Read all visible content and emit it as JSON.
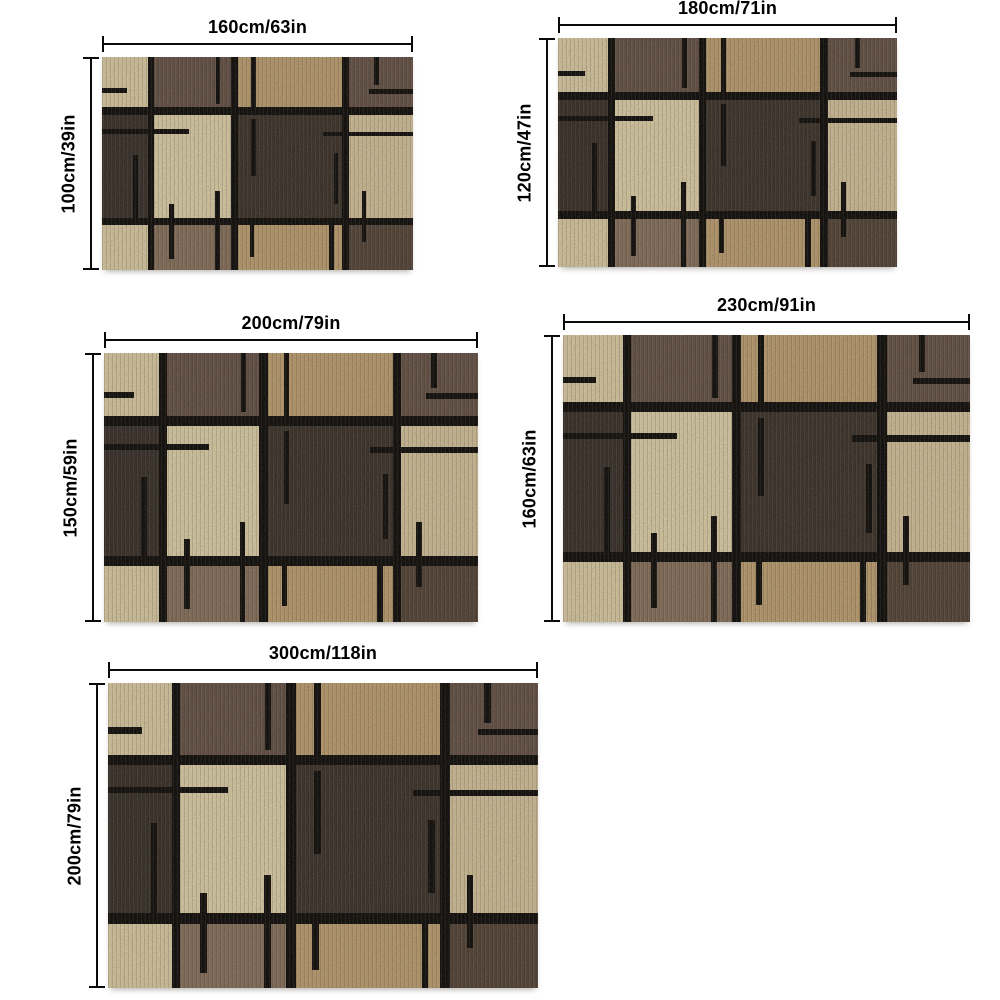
{
  "product": {
    "description": "Area rug size chart with five size variants shown as dimensioned photos"
  },
  "sizes": [
    {
      "id": "160x100",
      "width_label": "160cm/63in",
      "height_label": "100cm/39in"
    },
    {
      "id": "180x120",
      "width_label": "180cm/71in",
      "height_label": "120cm/47in"
    },
    {
      "id": "200x150",
      "width_label": "200cm/79in",
      "height_label": "150cm/59in"
    },
    {
      "id": "230x160",
      "width_label": "230cm/91in",
      "height_label": "160cm/63in"
    },
    {
      "id": "300x200",
      "width_label": "300cm/118in",
      "height_label": "200cm/79in"
    }
  ],
  "colors": {
    "dimension_line": "#0a0a0a",
    "label_text": "#000000",
    "grid_line": "#0b0805",
    "beige": "#cdbe97",
    "brown": "#5e4b3f",
    "camel": "#b19468",
    "espresso": "#332a23",
    "cream": "#d0c29c",
    "charcoal": "#372e25",
    "sand": "#c6b58f",
    "taupe": "#7e6854",
    "umber": "#4e3e31"
  }
}
